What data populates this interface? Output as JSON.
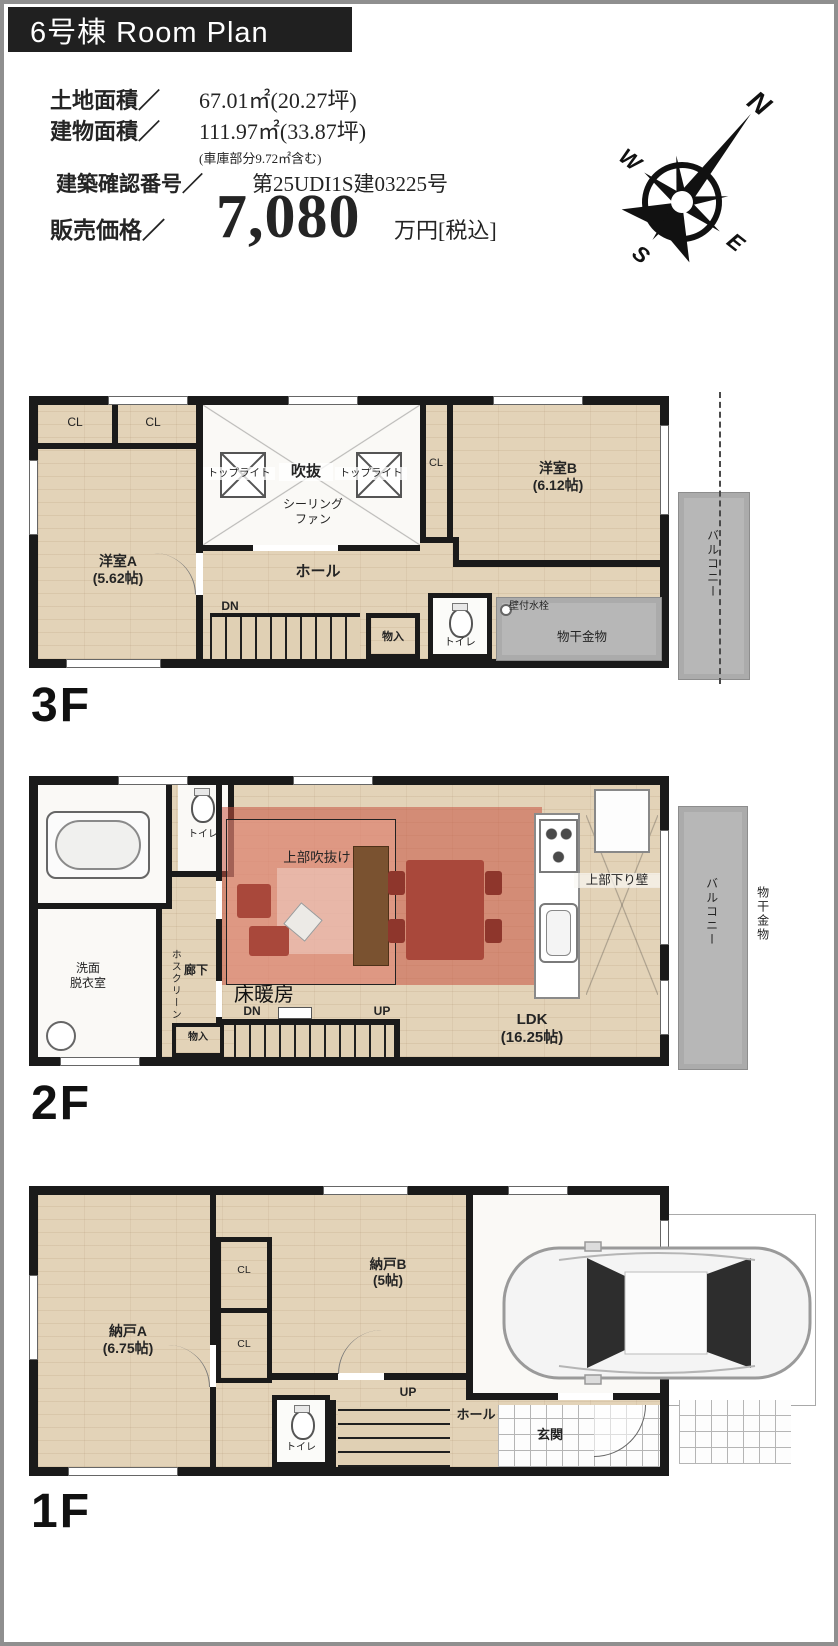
{
  "header": {
    "title": "6号棟  Room Plan",
    "land_label": "土地面積／",
    "land_value": "67.01㎡(20.27坪)",
    "bldg_label": "建物面積／",
    "bldg_value": "111.97㎡(33.87坪)",
    "bldg_note": "(車庫部分9.72㎡含む)",
    "kakunin_label": "建築確認番号／",
    "kakunin_value": "第25UDI1S建03225号",
    "price_label": "販売価格／",
    "price_value": "7,080",
    "price_unit": "万円[税込]"
  },
  "compass": {
    "n": "N",
    "e": "E",
    "s": "S",
    "w": "W"
  },
  "f3": {
    "floor_label": "3F",
    "cl1": "CL",
    "cl2": "CL",
    "cl3": "CL",
    "room_a": "洋室A\n(5.62帖)",
    "toplight1": "トップライト",
    "void": "吹抜",
    "toplight2": "トップライト",
    "ceiling_fan": "シーリング\nファン",
    "hall": "ホール",
    "dn": "DN",
    "storage": "物入",
    "toilet": "トイレ",
    "room_b": "洋室B\n(6.12帖)",
    "wall_faucet": "壁付水栓",
    "drying": "物干金物",
    "balcony": "バルコニー"
  },
  "f2": {
    "floor_label": "2F",
    "toilet": "トイレ",
    "washroom": "洗面\n脱衣室",
    "hoscreen": "ホスクリーン",
    "corridor": "廊下",
    "storage": "物入",
    "dn": "DN",
    "up": "UP",
    "void_above": "上部吹抜け",
    "floor_heating": "床暖房",
    "hanging_wall": "上部下り壁",
    "ldk": "LDK\n(16.25帖)",
    "balcony": "バルコニー",
    "drying": "物干金物"
  },
  "f1": {
    "floor_label": "1F",
    "storage_a": "納戸A\n(6.75帖)",
    "cl1": "CL",
    "cl2": "CL",
    "storage_b": "納戸B\n(5帖)",
    "toilet": "トイレ",
    "up": "UP",
    "hall": "ホール",
    "entrance": "玄関"
  }
}
